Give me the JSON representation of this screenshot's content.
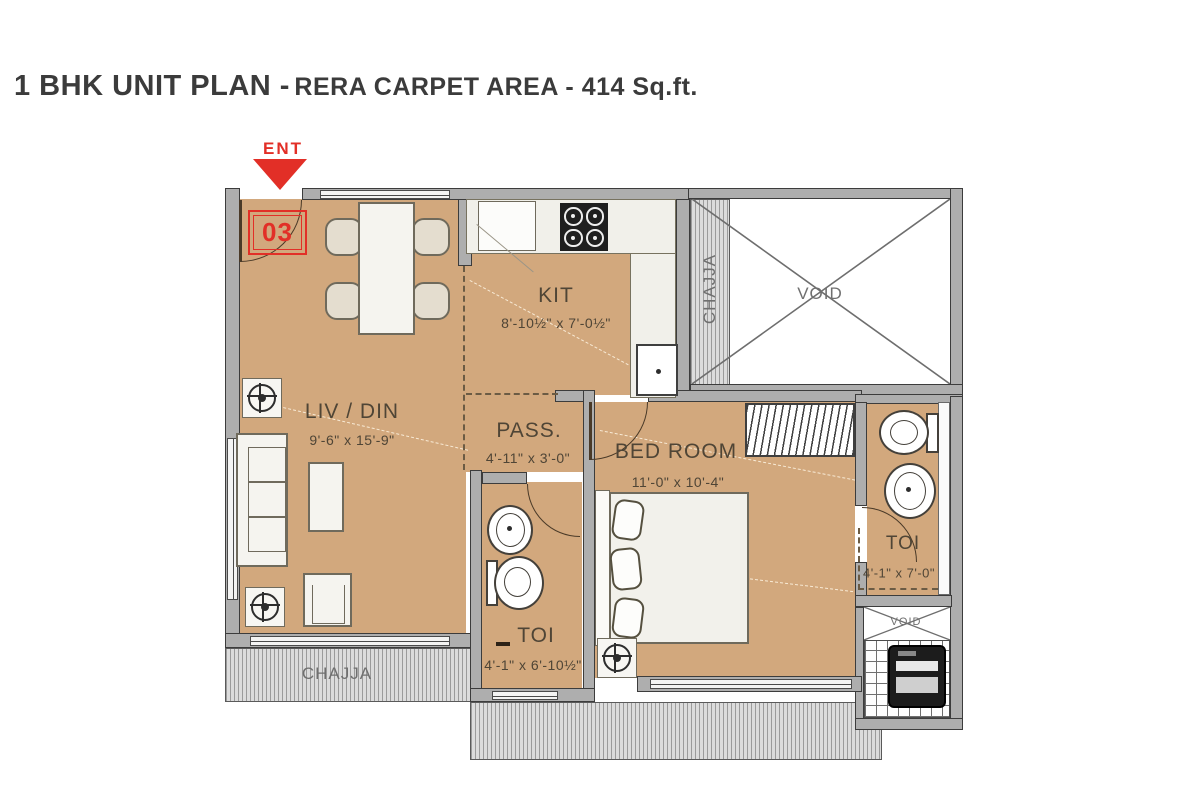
{
  "title": {
    "main": "1 BHK UNIT PLAN -",
    "sub": "RERA CARPET AREA - 414 Sq.ft."
  },
  "entrance": {
    "label": "ENT",
    "unit_number": "03"
  },
  "rooms": {
    "living": {
      "name": "LIV / DIN",
      "dims": "9'-6\" x 15'-9\""
    },
    "kitchen": {
      "name": "KIT",
      "dims": "8'-10½\" x 7'-0½\""
    },
    "passage": {
      "name": "PASS.",
      "dims": "4'-11\" x 3'-0\""
    },
    "bedroom": {
      "name": "BED ROOM",
      "dims": "11'-0\" x 10'-4\""
    },
    "toilet_bottom": {
      "name": "TOI",
      "dims": "4'-1\" x 6'-10½\""
    },
    "toilet_right": {
      "name": "TOI",
      "dims": "4'-1\" x 7'-0\""
    },
    "void_main": {
      "name": "VOID"
    },
    "void_small": {
      "name": "VOID"
    },
    "chajja_right": {
      "name": "CHAJJA"
    },
    "chajja_bottom": {
      "name": "CHAJJA"
    }
  },
  "colors": {
    "accent_red": "#e22f27",
    "floor_tan": "#d2a87d",
    "wall_gray": "#aeaeae",
    "outline_dark": "#3c3c3c",
    "label_brown": "#4f4536"
  }
}
